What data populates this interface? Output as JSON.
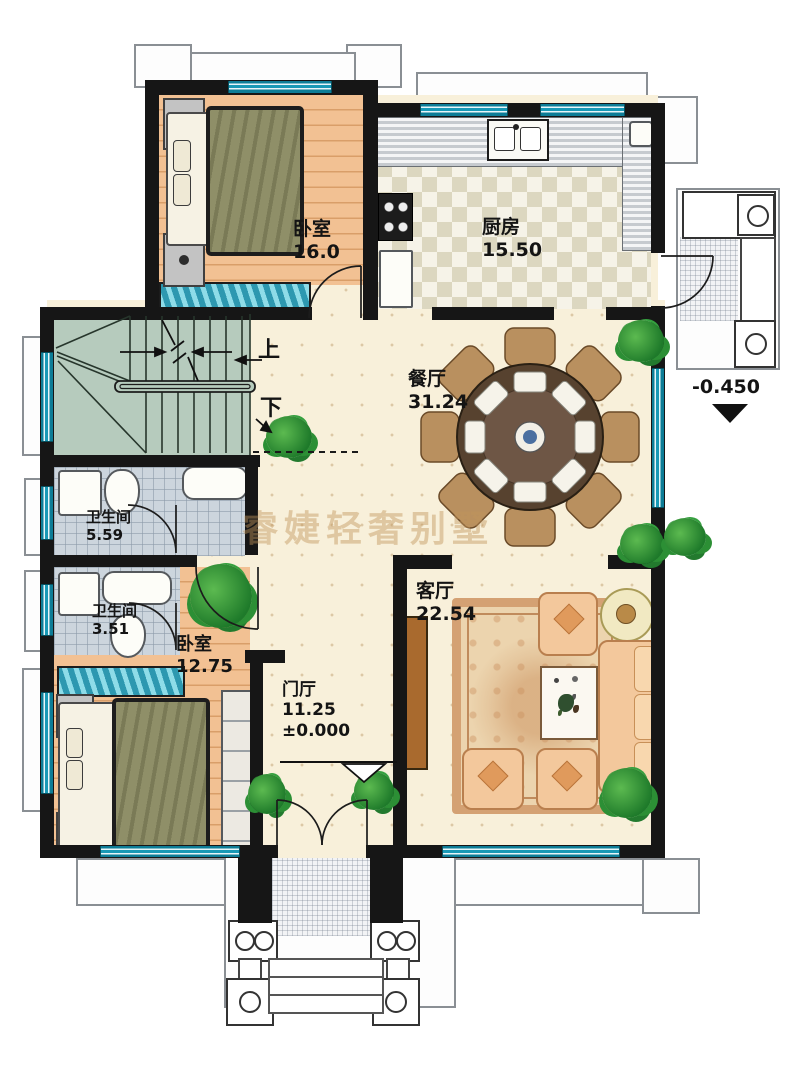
{
  "watermark": "睿婕轻奢别墅",
  "rooms": {
    "bedroom_top": {
      "label": "卧室",
      "area": "16.0"
    },
    "kitchen": {
      "label": "厨房",
      "area": "15.50"
    },
    "dining": {
      "label": "餐厅",
      "area": "31.24"
    },
    "bathroom_upper": {
      "label": "卫生间",
      "area": "5.59"
    },
    "bathroom_lower": {
      "label": "卫生间",
      "area": "3.51"
    },
    "bedroom_bottom": {
      "label": "卧室",
      "area": "12.75"
    },
    "foyer": {
      "label": "门厅",
      "area": "11.25",
      "elevation": "±0.000"
    },
    "living": {
      "label": "客厅",
      "area": "22.54"
    }
  },
  "stairs": {
    "up_label": "上",
    "down_label": "下"
  },
  "markers": {
    "side_entry_elevation": "-0.450"
  },
  "colors": {
    "wall": "#161616",
    "window_teal": "#1899b6",
    "floor_beige": "#f8f0da",
    "floor_wood": "#f2c193",
    "stair_green": "#b6cbbd",
    "watermark": "#c1945a"
  }
}
